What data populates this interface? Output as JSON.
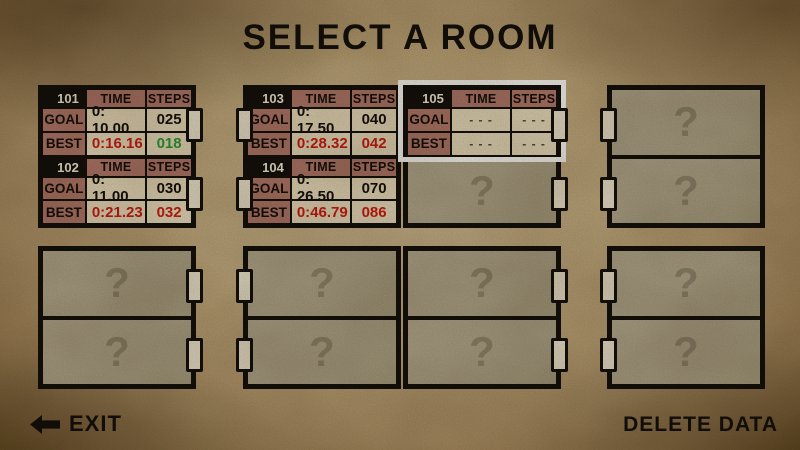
{
  "title": "SELECT A ROOM",
  "labels": {
    "time": "TIME",
    "steps": "STEPS",
    "goal": "GOAL",
    "best": "BEST",
    "unknown": "?"
  },
  "rooms": [
    {
      "id": "101",
      "goal_time": "0: 10.00",
      "goal_steps": "025",
      "best_time": "0:16.16",
      "best_steps": "018"
    },
    {
      "id": "102",
      "goal_time": "0: 11.00",
      "goal_steps": "030",
      "best_time": "0:21.23",
      "best_steps": "032"
    },
    {
      "id": "103",
      "goal_time": "0: 17.50",
      "goal_steps": "040",
      "best_time": "0:28.32",
      "best_steps": "042"
    },
    {
      "id": "104",
      "goal_time": "0: 26.50",
      "goal_steps": "070",
      "best_time": "0:46.79",
      "best_steps": "086"
    },
    {
      "id": "105",
      "goal_time": "- - -",
      "goal_steps": "- - -",
      "best_time": "- - -",
      "best_steps": "- - -"
    }
  ],
  "footer": {
    "exit": "EXIT",
    "delete": "DELETE DATA"
  },
  "colors": {
    "background_center": "#cfba92",
    "background_edge": "#83662f",
    "card_cream": "#ece0c1",
    "card_rose": "#b47b6c",
    "card_black": "#15100b",
    "best_red": "#cf1c12",
    "goal_green": "#2f9e38",
    "selection_white": "#ffffff",
    "unknown_panel": "#b2a88c",
    "unknown_mark": "#93896f"
  }
}
